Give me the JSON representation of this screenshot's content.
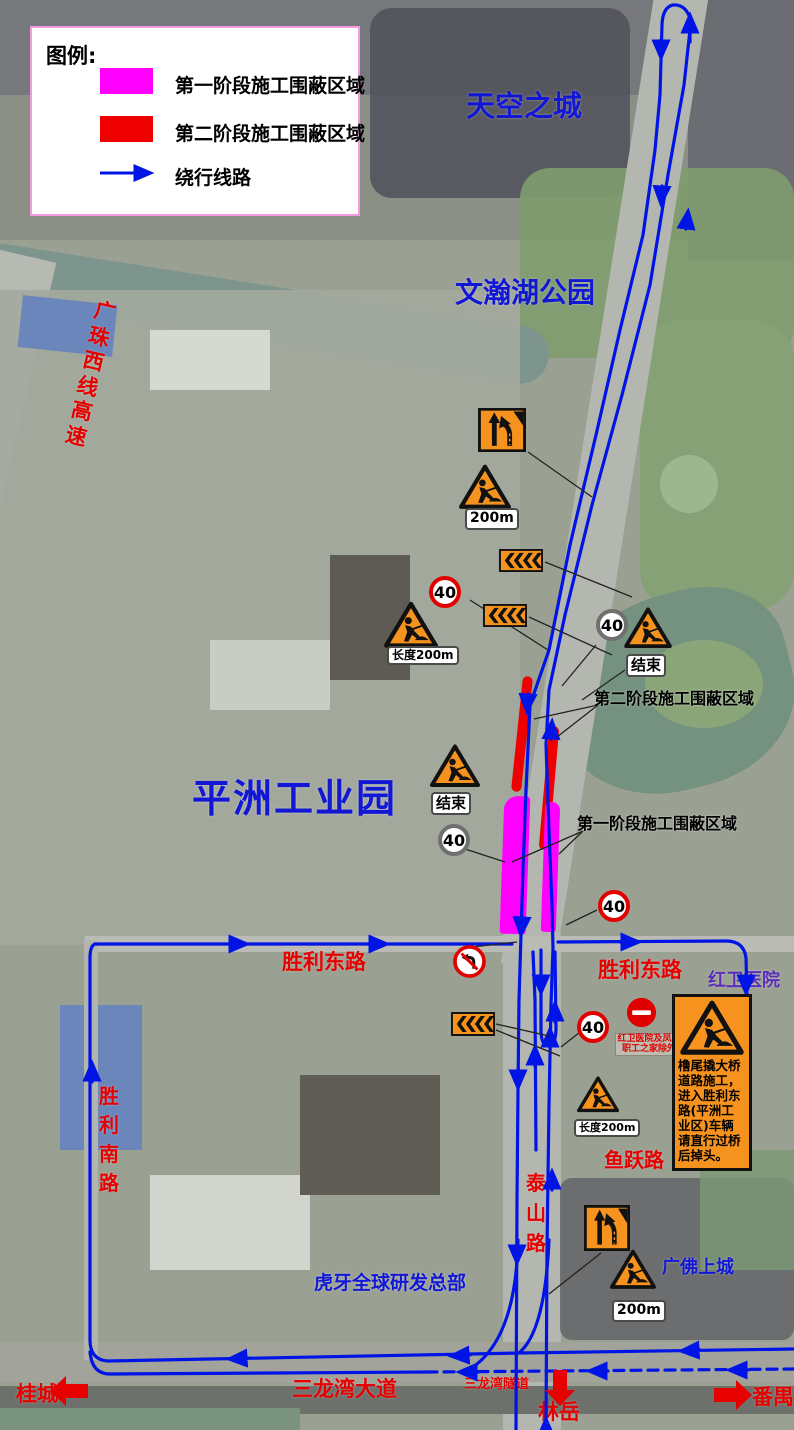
{
  "legend": {
    "title": "图例:",
    "items": [
      {
        "id": "phase1",
        "label": "第一阶段施工围蔽区域",
        "color": "#ff00ff"
      },
      {
        "id": "phase2",
        "label": "第二阶段施工围蔽区域",
        "color": "#ee0000"
      },
      {
        "id": "detour",
        "label": "绕行线路",
        "color": "#0014e6"
      }
    ]
  },
  "places": {
    "sky_city": "天空之城",
    "wenhan_park": "文瀚湖公园",
    "pingzhou_industrial": "平洲工业园",
    "huya_hq": "虎牙全球研发总部",
    "guangfo_upper": "广佛上城",
    "hongwei_hospital": "红卫医院"
  },
  "roads": {
    "guangzhu_west_expressway": "广珠西线高速",
    "shengli_east": "胜利东路",
    "shengli_south": "胜利南路",
    "taishan": "泰山路",
    "yuyue": "鱼跃路",
    "sanlongwan_avenue": "三龙湾大道",
    "sanlongwan_tunnel": "三龙湾隧道",
    "linyue": "林岳",
    "guicheng": "桂城",
    "panyu": "番禺"
  },
  "callouts": {
    "phase2": "第二阶段施工围蔽区域",
    "phase1": "第一阶段施工围蔽区域"
  },
  "signs": {
    "speed_limit": "40",
    "distance_200m": "200m",
    "length_200m": "长度200m",
    "end_label": "结束"
  },
  "notice": {
    "text": "橹尾撬大桥道路施工，进入胜利东路(平洲工业区)车辆请直行过桥后掉头。"
  },
  "restriction": {
    "line1": "红卫医院及凤鸣",
    "line2": "职工之家除外"
  },
  "colors": {
    "phase1": "#ff00ff",
    "phase2": "#ee0000",
    "route": "#0014e6"
  }
}
